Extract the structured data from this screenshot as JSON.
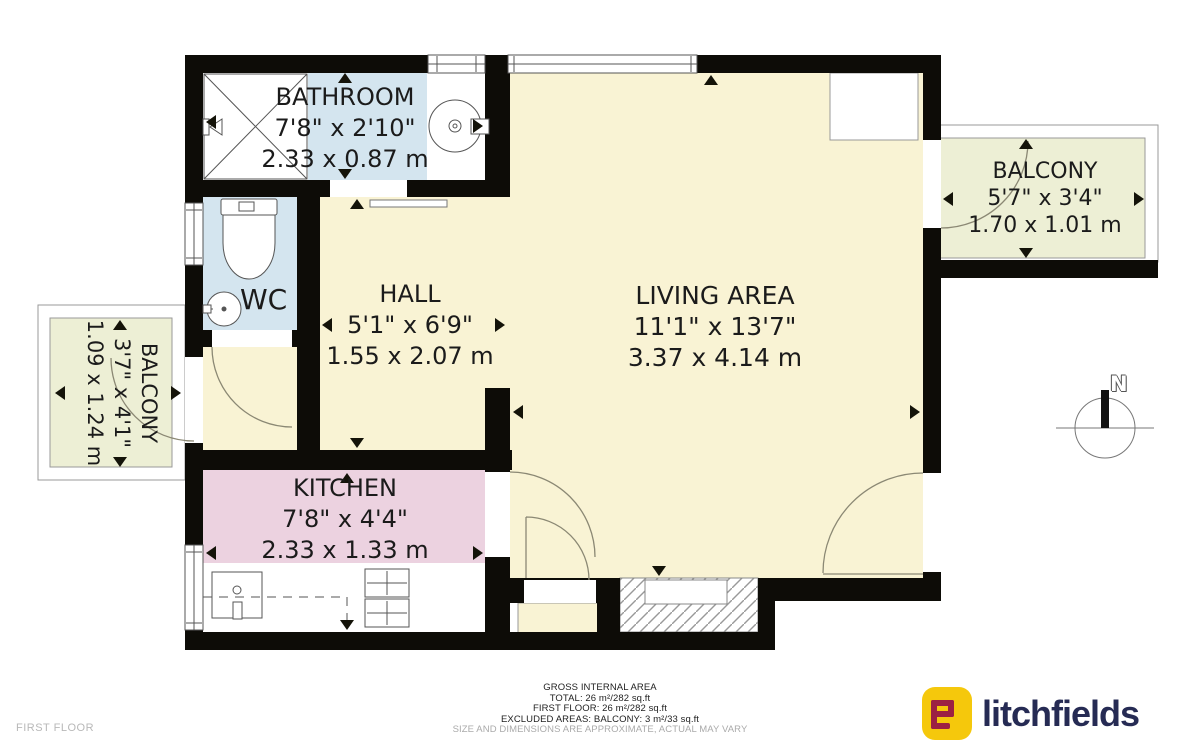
{
  "floorplan": {
    "rooms": {
      "bathroom": {
        "name": "BATHROOM",
        "imperial": "7'8\" x 2'10\"",
        "metric": "2.33 x 0.87 m"
      },
      "wc": {
        "name": "WC"
      },
      "hall": {
        "name": "HALL",
        "imperial": "5'1\" x 6'9\"",
        "metric": "1.55 x 2.07 m"
      },
      "living_area": {
        "name": "LIVING AREA",
        "imperial": "11'1\" x 13'7\"",
        "metric": "3.37 x 4.14 m"
      },
      "kitchen": {
        "name": "KITCHEN",
        "imperial": "7'8\" x 4'4\"",
        "metric": "2.33 x 1.33 m"
      },
      "balcony_left": {
        "name": "BALCONY",
        "imperial": "3'7\" x 4'1\"",
        "metric": "1.09 x 1.24 m"
      },
      "balcony_right": {
        "name": "BALCONY",
        "imperial": "5'7\" x 3'4\"",
        "metric": "1.70 x 1.01 m"
      }
    },
    "compass": {
      "north_label": "N"
    },
    "floor_label": "FIRST FLOOR"
  },
  "footer": {
    "area_summary": {
      "title": "GROSS INTERNAL AREA",
      "total": "TOTAL: 26 m²/282 sq.ft",
      "first_floor": "FIRST FLOOR: 26 m²/282 sq.ft",
      "excluded": "EXCLUDED AREAS: BALCONY: 3 m²/33 sq.ft",
      "disclaimer": "SIZE AND DIMENSIONS ARE APPROXIMATE, ACTUAL MAY VARY"
    },
    "brand": {
      "name": "litchfields"
    }
  },
  "colors": {
    "wall": "#0d0c07",
    "floor_yellow": "#f9f3d4",
    "bathroom_blue": "#d4e5ef",
    "kitchen_pink": "#ecd2e0",
    "balcony_green": "#edefd5",
    "arc_stroke": "#8b8874",
    "logo_yellow": "#f5c80c",
    "logo_maroon": "#9c2143",
    "logo_navy": "#262b54"
  }
}
